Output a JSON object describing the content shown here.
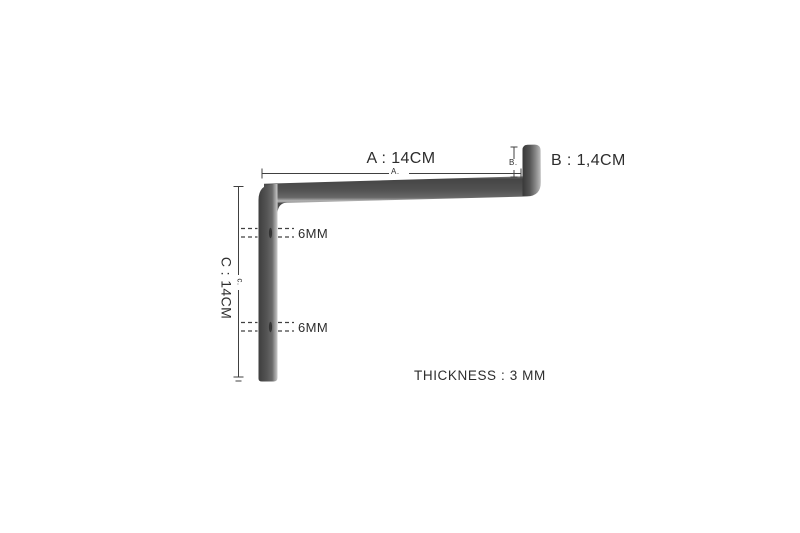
{
  "diagram": {
    "labels": {
      "dim_a": "A : 14CM",
      "dim_a_small": "A.",
      "dim_b": "B : 1,4CM",
      "dim_b_small": "B.",
      "dim_c": "C : 14CM",
      "dim_c_small": "c.",
      "hole_top": "6MM",
      "hole_bottom": "6MM",
      "thickness": "THICKNESS : 3 MM"
    },
    "dimensions": {
      "a_cm": 14,
      "b_cm": 1.4,
      "c_cm": 14,
      "hole_mm": 6,
      "thickness_mm": 3
    },
    "colors": {
      "background": "#ffffff",
      "text": "#2d2d2d",
      "dim_line": "#404040",
      "metal_dark": "#3e3e3e",
      "metal_mid": "#565656",
      "metal_soft": "#6a6a6a",
      "metal_light": "#a8a8a8",
      "metal_highlight": "#c9c9c9",
      "hole_slit": "#2c2c2c"
    }
  }
}
